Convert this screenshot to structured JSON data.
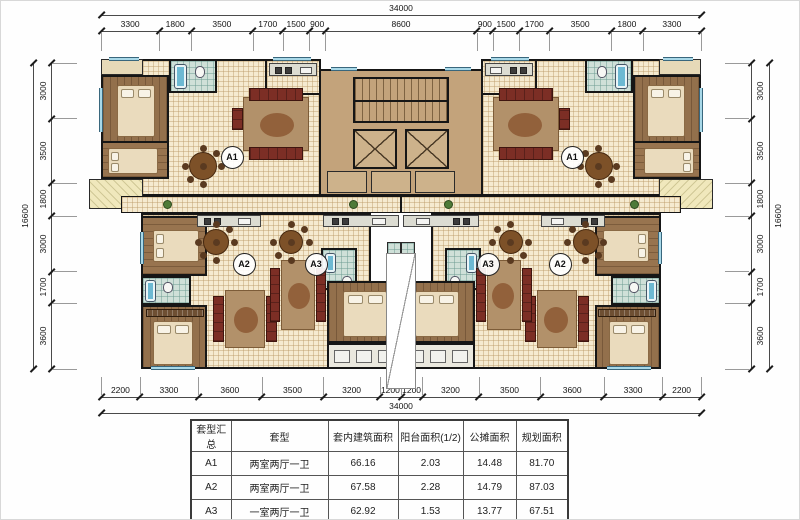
{
  "drawing": {
    "type": "residential-floor-plan",
    "dimensions": {
      "top": {
        "total": "34000",
        "segments": [
          "3300",
          "1800",
          "3500",
          "1700",
          "1500",
          "900",
          "8600",
          "900",
          "1500",
          "1700",
          "3500",
          "1800",
          "3300"
        ]
      },
      "bottom": {
        "total": "34000",
        "segments": [
          "2200",
          "3300",
          "3600",
          "3500",
          "3200",
          "1200",
          "1200",
          "3200",
          "3500",
          "3600",
          "3300",
          "2200"
        ]
      },
      "left": {
        "total": "16600",
        "segments": [
          "3000",
          "3500",
          "1800",
          "3000",
          "1700",
          "3600"
        ]
      },
      "right": {
        "total": "16600",
        "segments": [
          "3000",
          "3500",
          "1800",
          "3000",
          "1700",
          "3600"
        ]
      }
    },
    "units": [
      {
        "label": "A1",
        "x": 230,
        "y": 155
      },
      {
        "label": "A2",
        "x": 242,
        "y": 262
      },
      {
        "label": "A3",
        "x": 314,
        "y": 262
      },
      {
        "label": "A3",
        "x": 486,
        "y": 262
      },
      {
        "label": "A2",
        "x": 558,
        "y": 262
      },
      {
        "label": "A1",
        "x": 570,
        "y": 155
      }
    ],
    "colors": {
      "wall": "#161616",
      "core": "#c3a37b",
      "tile_floor": "#f5ead0",
      "wood_floor": "#93704c",
      "bathroom": "#cfe0d8",
      "balcony": "#f0e8bc",
      "window": "#a8d8e8",
      "sofa": "#7c2e25"
    }
  },
  "table": {
    "headers": [
      "套型汇总",
      "套型",
      "套内建筑面积",
      "阳台面积(1/2)",
      "公摊面积",
      "规划面积"
    ],
    "rows": [
      [
        "A1",
        "两室两厅一卫",
        "66.16",
        "2.03",
        "14.48",
        "81.70"
      ],
      [
        "A2",
        "两室两厅一卫",
        "67.58",
        "2.28",
        "14.79",
        "87.03"
      ],
      [
        "A3",
        "一室两厅一卫",
        "62.92",
        "1.53",
        "13.77",
        "67.51"
      ]
    ]
  }
}
